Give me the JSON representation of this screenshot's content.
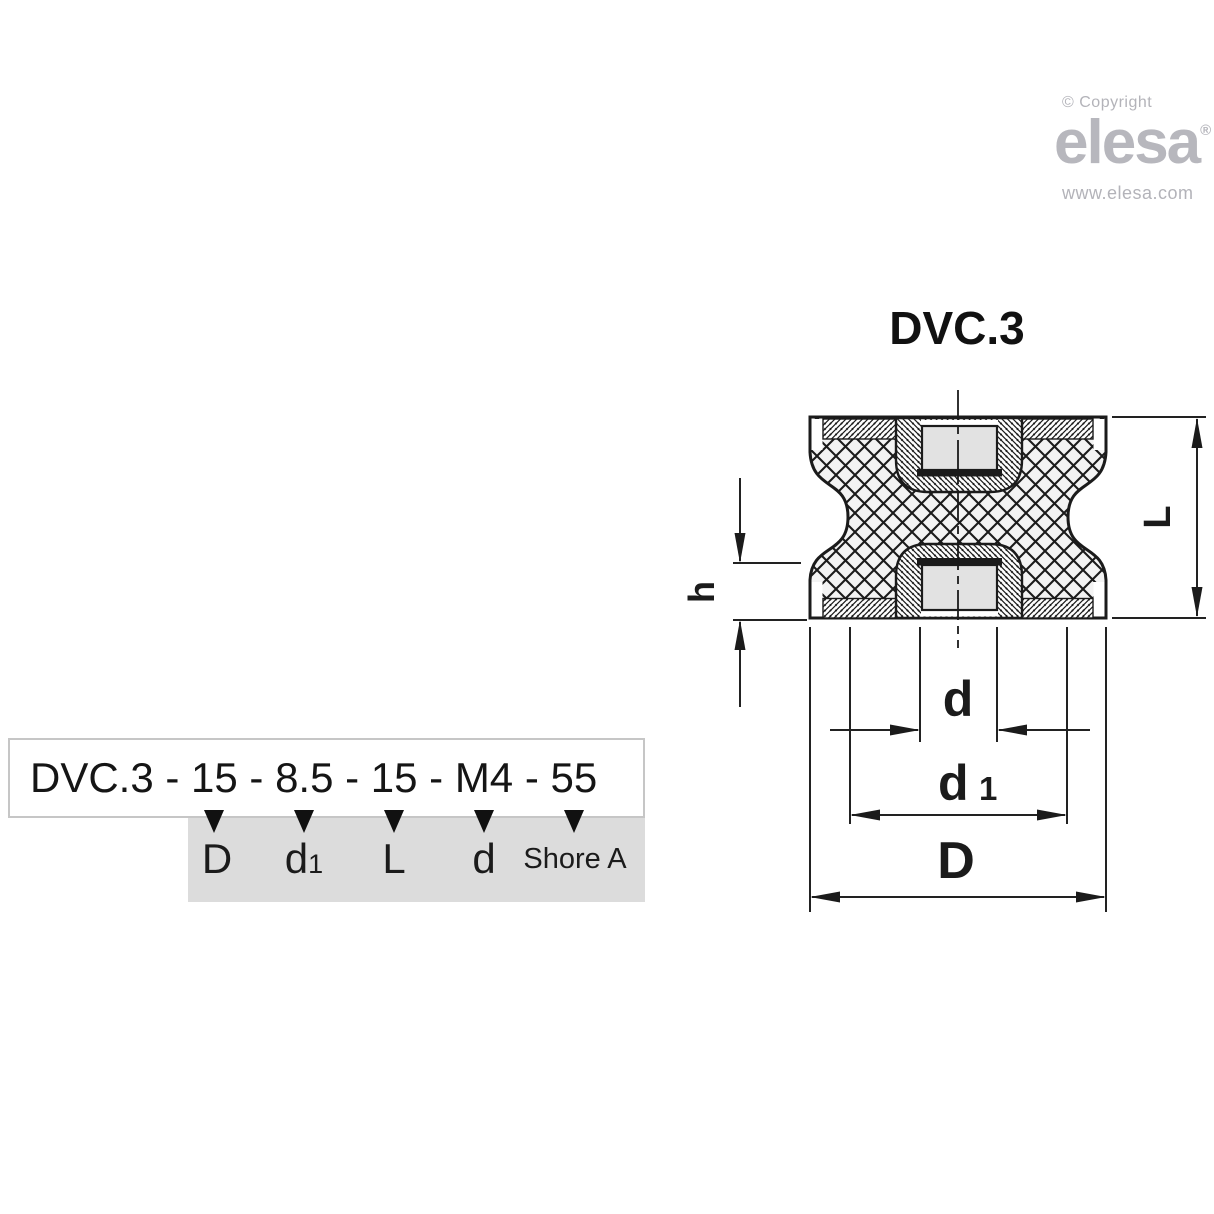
{
  "logo": {
    "copyright_line": "© Copyright",
    "wordmark": "elesa",
    "registered_mark": "®",
    "website": "www.elesa.com"
  },
  "drawing": {
    "title": "DVC.3",
    "dimension_labels": {
      "L": "L",
      "h": "h",
      "d": "d",
      "d1_base": "d",
      "d1_sub": "1",
      "D": "D"
    }
  },
  "order_code": {
    "text": "DVC.3 - 15 - 8.5 - 15 - M4 - 55",
    "labels": {
      "l1": "D",
      "l2_base": "d",
      "l2_sub": "1",
      "l3": "L",
      "l4": "d",
      "l5": "Shore A"
    }
  },
  "colors": {
    "line_black": "#1b1b1b",
    "panel_gray": "#dcdcdc",
    "box_border_gray": "#c6c6c6",
    "logo_gray": "#b7b7bd",
    "hole_fill_gray": "#e2e2e2",
    "rubber_fill": "#f3f3f3"
  }
}
